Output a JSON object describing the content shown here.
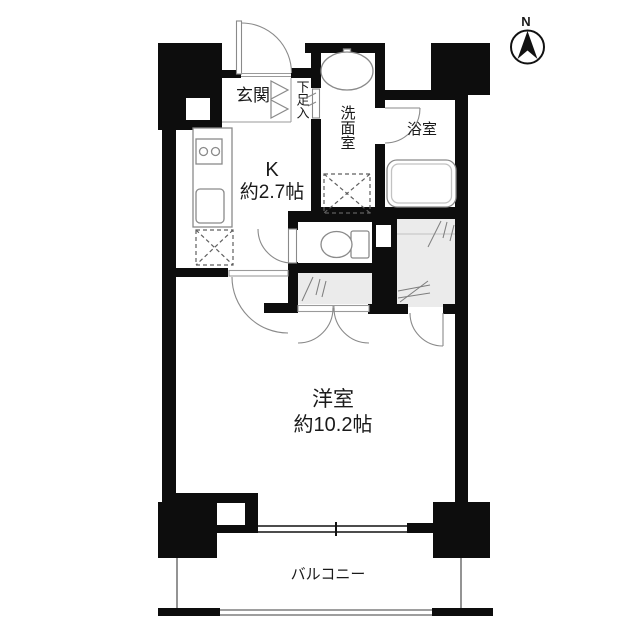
{
  "floorplan": {
    "rooms": {
      "entrance": {
        "label": "玄関"
      },
      "shoe_storage": {
        "label": "下足入"
      },
      "washroom": {
        "label": "洗面室"
      },
      "bathroom": {
        "label": "浴室"
      },
      "kitchen": {
        "label": "K",
        "size": "約2.7帖"
      },
      "western_room": {
        "label": "洋室",
        "size": "約10.2帖"
      },
      "balcony": {
        "label": "バルコニー"
      }
    },
    "compass": {
      "north_label": "N"
    },
    "colors": {
      "wall": "#0d0d0d",
      "fixture_line": "#8a8a8a",
      "closet_fill": "#ebebeb",
      "background": "#ffffff",
      "text": "#1a1a1a"
    }
  }
}
